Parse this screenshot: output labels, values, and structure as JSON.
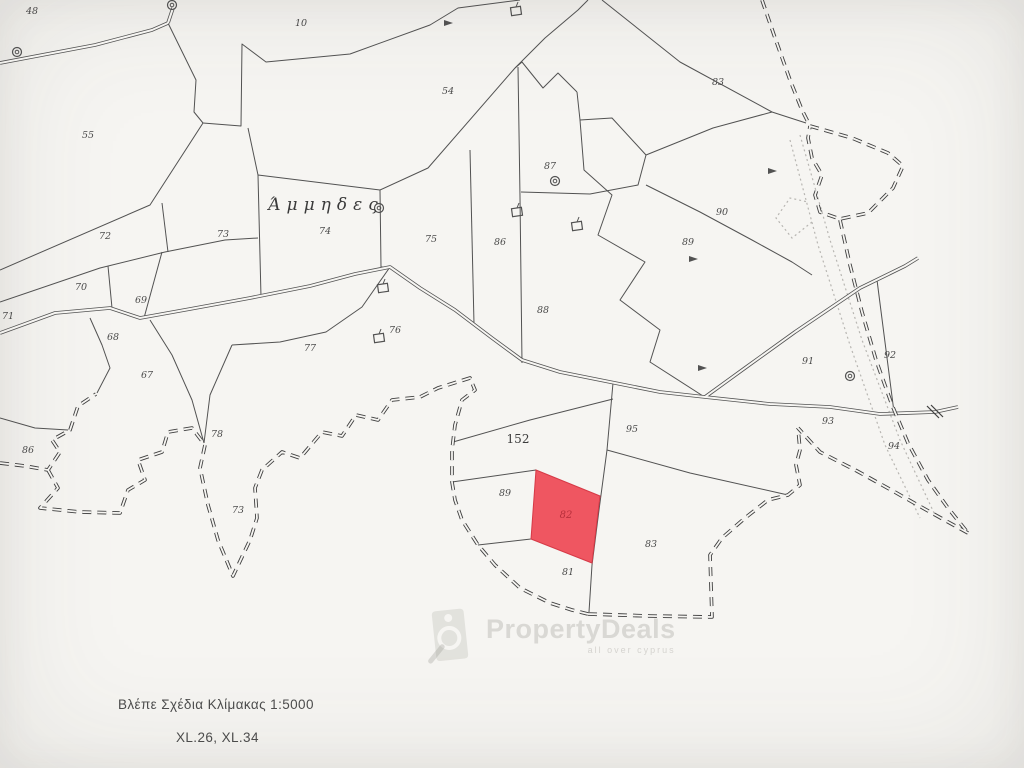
{
  "map": {
    "place_name": {
      "text": "Άμμηδες",
      "x": 318,
      "y": 196
    },
    "highlighted_parcel": {
      "number": "82",
      "fill_color": "#ee4956",
      "label_color": "#b8303c",
      "polygon": [
        [
          536,
          470
        ],
        [
          600,
          496
        ],
        [
          592,
          563
        ],
        [
          531,
          539
        ]
      ],
      "label_pos": [
        558,
        510
      ]
    },
    "parcel_labels": [
      {
        "n": "48",
        "x": 24,
        "y": 4
      },
      {
        "n": "10",
        "x": 293,
        "y": 16
      },
      {
        "n": "55",
        "x": 80,
        "y": 128
      },
      {
        "n": "54",
        "x": 440,
        "y": 84
      },
      {
        "n": "83",
        "x": 710,
        "y": 75
      },
      {
        "n": "87",
        "x": 542,
        "y": 159
      },
      {
        "n": "90",
        "x": 714,
        "y": 205
      },
      {
        "n": "89",
        "x": 680,
        "y": 235
      },
      {
        "n": "72",
        "x": 97,
        "y": 229
      },
      {
        "n": "73",
        "x": 215,
        "y": 227
      },
      {
        "n": "74",
        "x": 317,
        "y": 224
      },
      {
        "n": "75",
        "x": 423,
        "y": 232
      },
      {
        "n": "86",
        "x": 492,
        "y": 235
      },
      {
        "n": "88",
        "x": 535,
        "y": 303
      },
      {
        "n": "70",
        "x": 73,
        "y": 280
      },
      {
        "n": "69",
        "x": 133,
        "y": 293
      },
      {
        "n": "71",
        "x": 0,
        "y": 309
      },
      {
        "n": "68",
        "x": 105,
        "y": 330
      },
      {
        "n": "67",
        "x": 139,
        "y": 368
      },
      {
        "n": "77",
        "x": 302,
        "y": 341
      },
      {
        "n": "76",
        "x": 387,
        "y": 323
      },
      {
        "n": "78",
        "x": 209,
        "y": 427
      },
      {
        "n": "73",
        "x": 230,
        "y": 503
      },
      {
        "n": "86",
        "x": 20,
        "y": 443
      },
      {
        "n": "91",
        "x": 800,
        "y": 354
      },
      {
        "n": "92",
        "x": 882,
        "y": 348
      },
      {
        "n": "93",
        "x": 820,
        "y": 414
      },
      {
        "n": "94",
        "x": 886,
        "y": 439
      },
      {
        "n": "95",
        "x": 624,
        "y": 422
      },
      {
        "n": "89",
        "x": 497,
        "y": 486
      },
      {
        "n": "83",
        "x": 643,
        "y": 537
      },
      {
        "n": "81",
        "x": 560,
        "y": 565
      }
    ],
    "big_label": {
      "n": "152",
      "x": 506,
      "y": 430
    },
    "roads": [
      [
        [
          0,
          63
        ],
        [
          95,
          45
        ],
        [
          152,
          30
        ],
        [
          168,
          23
        ]
      ],
      [
        [
          168,
          23
        ],
        [
          173,
          8
        ]
      ],
      [
        [
          0,
          333
        ],
        [
          55,
          313
        ],
        [
          110,
          308
        ],
        [
          140,
          318
        ],
        [
          190,
          309
        ],
        [
          250,
          298
        ],
        [
          310,
          286
        ],
        [
          355,
          274
        ],
        [
          390,
          267
        ],
        [
          420,
          288
        ],
        [
          455,
          310
        ],
        [
          492,
          338
        ],
        [
          522,
          360
        ],
        [
          560,
          372
        ],
        [
          610,
          382
        ],
        [
          660,
          392
        ],
        [
          705,
          397
        ],
        [
          770,
          404
        ],
        [
          830,
          407
        ],
        [
          880,
          414
        ],
        [
          935,
          412
        ],
        [
          958,
          407
        ]
      ],
      [
        [
          705,
          397
        ],
        [
          745,
          368
        ],
        [
          795,
          332
        ],
        [
          860,
          288
        ],
        [
          905,
          266
        ],
        [
          918,
          258
        ]
      ]
    ],
    "boundaries": [
      [
        [
          168,
          23
        ],
        [
          196,
          80
        ],
        [
          194,
          112
        ],
        [
          203,
          123
        ]
      ],
      [
        [
          203,
          123
        ],
        [
          241,
          126
        ],
        [
          242,
          44
        ],
        [
          266,
          62
        ],
        [
          350,
          54
        ],
        [
          430,
          25
        ],
        [
          458,
          8
        ],
        [
          520,
          0
        ]
      ],
      [
        [
          203,
          123
        ],
        [
          150,
          205
        ],
        [
          0,
          270
        ]
      ],
      [
        [
          0,
          302
        ],
        [
          100,
          268
        ],
        [
          165,
          252
        ],
        [
          225,
          240
        ],
        [
          258,
          238
        ]
      ],
      [
        [
          108,
          266
        ],
        [
          112,
          308
        ]
      ],
      [
        [
          162,
          252
        ],
        [
          144,
          318
        ]
      ],
      [
        [
          162,
          203
        ],
        [
          168,
          252
        ]
      ],
      [
        [
          248,
          128
        ],
        [
          258,
          175
        ],
        [
          261,
          297
        ]
      ],
      [
        [
          258,
          175
        ],
        [
          380,
          190
        ]
      ],
      [
        [
          380,
          190
        ],
        [
          381,
          267
        ],
        [
          390,
          267
        ]
      ],
      [
        [
          380,
          190
        ],
        [
          428,
          168
        ],
        [
          515,
          68
        ]
      ],
      [
        [
          470,
          150
        ],
        [
          474,
          324
        ]
      ],
      [
        [
          518,
          67
        ],
        [
          520,
          197
        ],
        [
          522,
          363
        ]
      ],
      [
        [
          515,
          68
        ],
        [
          522,
          62
        ],
        [
          543,
          88
        ],
        [
          558,
          73
        ],
        [
          577,
          92
        ]
      ],
      [
        [
          577,
          92
        ],
        [
          580,
          120
        ],
        [
          612,
          118
        ],
        [
          646,
          155
        ],
        [
          638,
          185
        ],
        [
          590,
          194
        ],
        [
          521,
          192
        ]
      ],
      [
        [
          646,
          155
        ],
        [
          713,
          128
        ],
        [
          772,
          112
        ],
        [
          806,
          123
        ]
      ],
      [
        [
          646,
          185
        ],
        [
          700,
          212
        ],
        [
          752,
          240
        ],
        [
          792,
          262
        ],
        [
          812,
          275
        ]
      ],
      [
        [
          602,
          0
        ],
        [
          680,
          62
        ],
        [
          772,
          112
        ]
      ],
      [
        [
          515,
          68
        ],
        [
          545,
          38
        ],
        [
          578,
          10
        ],
        [
          588,
          0
        ]
      ],
      [
        [
          580,
          120
        ],
        [
          584,
          170
        ],
        [
          612,
          195
        ],
        [
          598,
          235
        ],
        [
          645,
          262
        ],
        [
          620,
          300
        ],
        [
          660,
          330
        ],
        [
          650,
          362
        ],
        [
          703,
          396
        ]
      ],
      [
        [
          877,
          280
        ],
        [
          886,
          350
        ],
        [
          894,
          412
        ]
      ],
      [
        [
          453,
          442
        ],
        [
          530,
          420
        ],
        [
          613,
          399
        ]
      ],
      [
        [
          613,
          383
        ],
        [
          607,
          450
        ],
        [
          599,
          510
        ],
        [
          592,
          565
        ],
        [
          589,
          612
        ]
      ],
      [
        [
          452,
          482
        ],
        [
          536,
          470
        ]
      ],
      [
        [
          607,
          450
        ],
        [
          690,
          473
        ],
        [
          788,
          495
        ]
      ],
      [
        [
          478,
          545
        ],
        [
          531,
          539
        ]
      ],
      [
        [
          390,
          267
        ],
        [
          362,
          307
        ],
        [
          326,
          332
        ],
        [
          280,
          342
        ],
        [
          232,
          345
        ]
      ],
      [
        [
          232,
          345
        ],
        [
          210,
          395
        ],
        [
          204,
          443
        ]
      ],
      [
        [
          90,
          318
        ],
        [
          102,
          345
        ],
        [
          110,
          368
        ],
        [
          97,
          393
        ]
      ],
      [
        [
          150,
          320
        ],
        [
          172,
          355
        ],
        [
          192,
          400
        ],
        [
          204,
          443
        ]
      ],
      [
        [
          0,
          418
        ],
        [
          35,
          428
        ],
        [
          68,
          430
        ]
      ]
    ],
    "survey_boundaries": [
      [
        [
          0,
          463
        ],
        [
          25,
          466
        ],
        [
          48,
          470
        ],
        [
          60,
          452
        ],
        [
          52,
          440
        ],
        [
          70,
          430
        ],
        [
          78,
          406
        ],
        [
          96,
          394
        ]
      ],
      [
        [
          48,
          470
        ],
        [
          58,
          488
        ],
        [
          40,
          508
        ],
        [
          80,
          512
        ],
        [
          120,
          513
        ],
        [
          128,
          490
        ],
        [
          145,
          480
        ],
        [
          138,
          460
        ],
        [
          162,
          452
        ],
        [
          168,
          432
        ],
        [
          192,
          428
        ],
        [
          205,
          445
        ],
        [
          200,
          468
        ],
        [
          208,
          505
        ],
        [
          218,
          540
        ],
        [
          233,
          576
        ],
        [
          250,
          540
        ],
        [
          257,
          518
        ],
        [
          255,
          488
        ],
        [
          262,
          470
        ],
        [
          282,
          452
        ],
        [
          300,
          458
        ],
        [
          322,
          432
        ],
        [
          342,
          436
        ],
        [
          356,
          415
        ],
        [
          378,
          420
        ],
        [
          392,
          400
        ],
        [
          420,
          397
        ],
        [
          438,
          388
        ],
        [
          470,
          378
        ],
        [
          475,
          390
        ],
        [
          462,
          400
        ],
        [
          455,
          425
        ],
        [
          452,
          450
        ],
        [
          452,
          482
        ],
        [
          455,
          500
        ],
        [
          462,
          520
        ],
        [
          478,
          545
        ],
        [
          495,
          565
        ],
        [
          520,
          588
        ],
        [
          550,
          603
        ],
        [
          572,
          610
        ],
        [
          588,
          614
        ]
      ],
      [
        [
          588,
          614
        ],
        [
          650,
          616
        ],
        [
          712,
          617
        ],
        [
          710,
          555
        ],
        [
          722,
          538
        ],
        [
          745,
          518
        ],
        [
          768,
          500
        ],
        [
          788,
          495
        ],
        [
          800,
          485
        ],
        [
          796,
          465
        ],
        [
          800,
          450
        ],
        [
          798,
          428
        ]
      ],
      [
        [
          968,
          533
        ],
        [
          930,
          512
        ],
        [
          893,
          491
        ],
        [
          857,
          471
        ],
        [
          820,
          452
        ],
        [
          798,
          428
        ]
      ],
      [
        [
          840,
          220
        ],
        [
          850,
          265
        ],
        [
          862,
          312
        ],
        [
          876,
          360
        ],
        [
          892,
          405
        ],
        [
          908,
          443
        ],
        [
          928,
          480
        ],
        [
          948,
          508
        ],
        [
          968,
          533
        ]
      ],
      [
        [
          762,
          0
        ],
        [
          774,
          35
        ],
        [
          790,
          80
        ],
        [
          802,
          110
        ],
        [
          810,
          126
        ]
      ],
      [
        [
          810,
          126
        ],
        [
          852,
          138
        ],
        [
          888,
          153
        ],
        [
          903,
          166
        ],
        [
          893,
          188
        ],
        [
          868,
          213
        ],
        [
          840,
          219
        ],
        [
          820,
          212
        ],
        [
          815,
          195
        ],
        [
          822,
          175
        ],
        [
          812,
          158
        ],
        [
          808,
          138
        ],
        [
          810,
          126
        ]
      ]
    ],
    "dotted_tracks": [
      [
        [
          800,
          135
        ],
        [
          830,
          240
        ],
        [
          862,
          340
        ],
        [
          900,
          440
        ],
        [
          935,
          515
        ]
      ],
      [
        [
          790,
          140
        ],
        [
          818,
          245
        ],
        [
          850,
          345
        ],
        [
          885,
          445
        ],
        [
          920,
          518
        ]
      ],
      [
        [
          812,
          222
        ],
        [
          792,
          238
        ],
        [
          776,
          218
        ],
        [
          790,
          198
        ],
        [
          808,
          202
        ]
      ]
    ],
    "wells": [
      [
        17,
        52
      ],
      [
        172,
        5
      ],
      [
        379,
        208
      ],
      [
        555,
        181
      ],
      [
        850,
        376
      ]
    ],
    "buildings": [
      [
        383,
        288
      ],
      [
        379,
        338
      ],
      [
        517,
        212
      ],
      [
        577,
        226
      ],
      [
        516,
        11
      ]
    ],
    "arrows": [
      [
        448,
        23
      ],
      [
        772,
        171
      ],
      [
        693,
        259
      ],
      [
        702,
        368
      ]
    ],
    "road_crossing": [
      933,
      412
    ],
    "colors": {
      "background": "#f6f5f2",
      "line": "#525252",
      "survey_line": "#3f3f3f",
      "label": "#4a4a4a",
      "dotted": "#b8b6b2"
    }
  },
  "watermark": {
    "brand": "PropertyDeals",
    "tagline": "all over cyprus"
  },
  "notes": {
    "line1": "Βλέπε Σχέδια Κλίμακας 1:5000",
    "line2": "XL.26, XL.34"
  }
}
